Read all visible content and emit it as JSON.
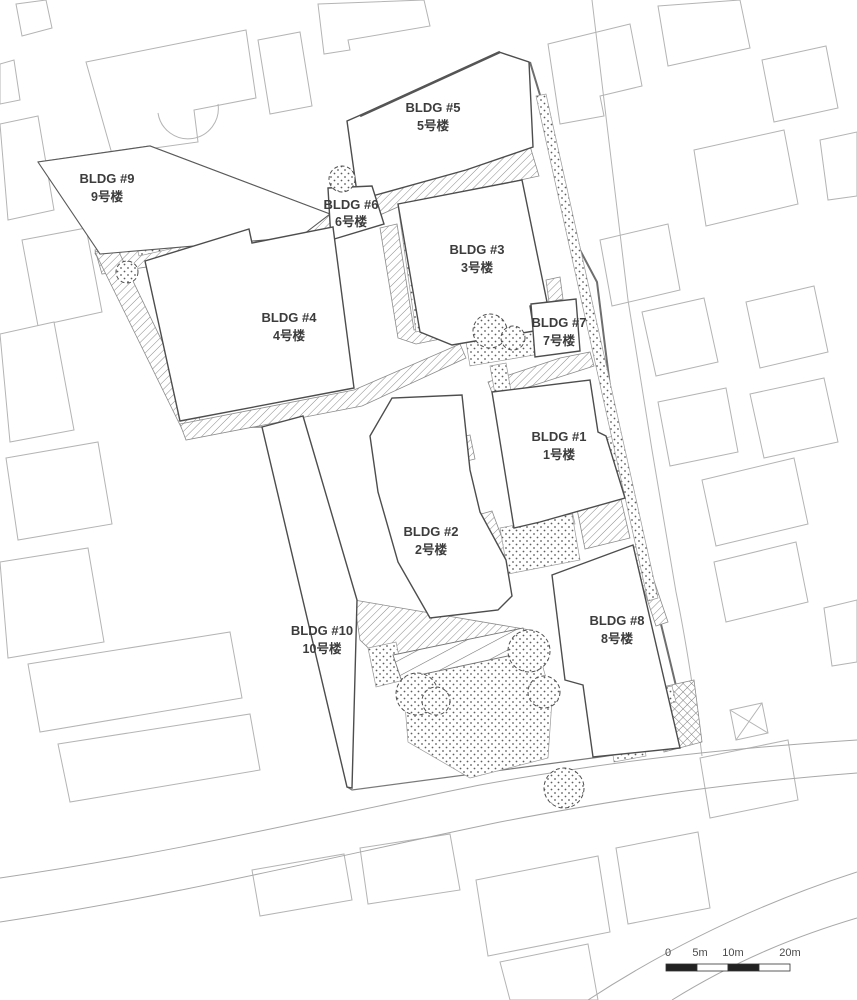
{
  "drawing": {
    "kind": "architectural site plan",
    "buildings": [
      {
        "num": 1,
        "label_en": "BLDG #1",
        "label_zh": "1号楼"
      },
      {
        "num": 2,
        "label_en": "BLDG #2",
        "label_zh": "2号楼"
      },
      {
        "num": 3,
        "label_en": "BLDG #3",
        "label_zh": "3号楼"
      },
      {
        "num": 4,
        "label_en": "BLDG #4",
        "label_zh": "4号楼"
      },
      {
        "num": 5,
        "label_en": "BLDG #5",
        "label_zh": "5号楼"
      },
      {
        "num": 6,
        "label_en": "BLDG #6",
        "label_zh": "6号楼"
      },
      {
        "num": 7,
        "label_en": "BLDG #7",
        "label_zh": "7号楼"
      },
      {
        "num": 8,
        "label_en": "BLDG #8",
        "label_zh": "8号楼"
      },
      {
        "num": 9,
        "label_en": "BLDG #9",
        "label_zh": "9号楼"
      },
      {
        "num": 10,
        "label_en": "BLDG #10",
        "label_zh": "10号楼"
      }
    ],
    "scale_bar": {
      "ticks": [
        "0",
        "5m",
        "10m",
        "20m"
      ]
    },
    "colors": {
      "background": "#ffffff",
      "context_line": "#b4b4b4",
      "building_line": "#4d4d4d",
      "hatch_line": "#8c8c8c",
      "label_text": "#3c3c3c"
    }
  }
}
